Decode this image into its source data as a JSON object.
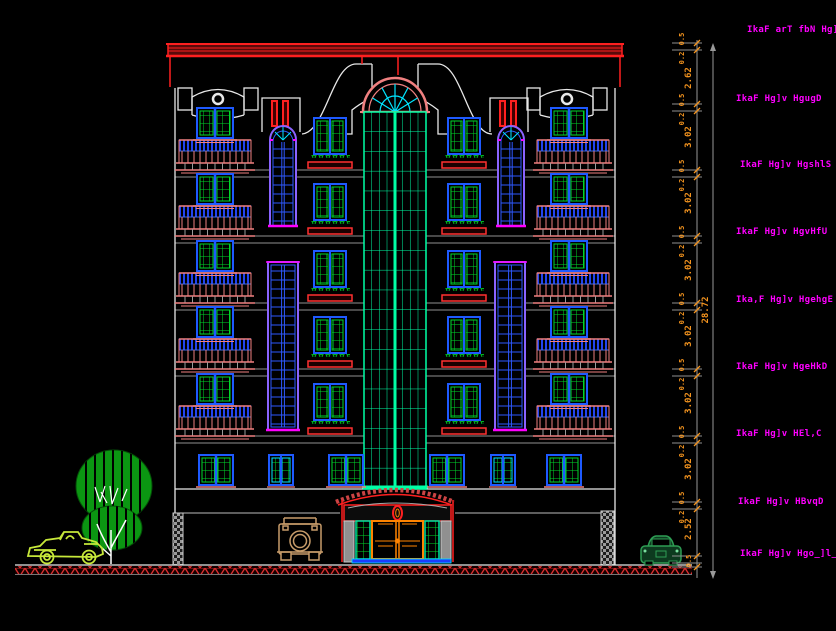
{
  "drawing": {
    "type": "cad-building-front-elevation",
    "background": "#000000"
  },
  "labels": [
    "IkaF arT fbN Hg]M[",
    "IkaF Hg]v HgugD",
    "IkaF Hg]v HgshlS",
    "IkaF Hg]v HgvHfU",
    "Ika,F Hg]v HgehgE",
    "IkaF Hg]v HgeHkD",
    "IkaF Hg]v HEl,C",
    "IkaF Hg]v HBvqD",
    "IkaF Hg]v Hgo_]l__m"
  ],
  "dimensions": {
    "overall": "28.72",
    "segments": [
      "2.62",
      "3.02",
      "3.02",
      "3.02",
      "3.02",
      "3.02",
      "3.02",
      "2.52",
      "0.5"
    ],
    "sub_top": "0.5",
    "sub_bottom": "0.2"
  },
  "colors": {
    "label": "#ff00ff",
    "dimension": "#f5941e",
    "cornice_red": "#ff2020",
    "parapet_white": "#e8e8e8",
    "balcony_salmon": "#f08080",
    "window_blue": "#1e5aff",
    "pane_green": "#00d62a",
    "tower_green": "#00ffa6",
    "stair_purple": "#8a63ff",
    "accent_cyan": "#00e5ff",
    "tree_green": "#0b9612",
    "car_left_chartreuse": "#c7e83a",
    "car_right_green": "#2e9e54",
    "jeep_tan": "#c79c6a",
    "ground_hatch_red": "#e03030"
  }
}
